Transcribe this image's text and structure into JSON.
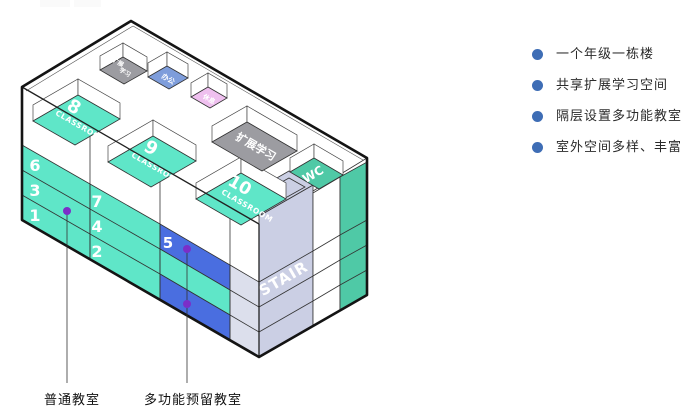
{
  "legend": {
    "items": [
      "一个年级一栋楼",
      "共享扩展学习空间",
      "隔层设置多功能教室",
      "室外空间多样、丰富"
    ]
  },
  "callouts": {
    "ordinary": "普通教室",
    "multi": "多功能预留教室"
  },
  "building": {
    "front": {
      "colA": [
        "6",
        "3",
        "1"
      ],
      "colB": [
        "7",
        "4",
        "2"
      ],
      "multiFloor": "5"
    },
    "rooms": {
      "r8": {
        "num": "8",
        "type": "CLASSROOM"
      },
      "r9": {
        "num": "9",
        "type": "CLASSROOM"
      },
      "r10": {
        "num": "10",
        "type": "CLASSROOM"
      },
      "grayTop": {
        "line1": "扩展",
        "line2": "学习"
      },
      "office": "办公",
      "rest": "休息",
      "expand": "扩展学习",
      "wc": "WC",
      "stair": "STAIR"
    }
  },
  "colors": {
    "teal": "#5FE6C8",
    "tealSide": "#4FC9A6",
    "blue": "#4A6EE0",
    "officeBlue": "#7E9DDB",
    "pink": "#EFC0EF",
    "gray": "#9C9CA1",
    "lavender": "#CBCFE4",
    "lavenderLight": "#DCDFEC",
    "purple": "#7B2EC8",
    "bullet": "#3E6DB5"
  }
}
